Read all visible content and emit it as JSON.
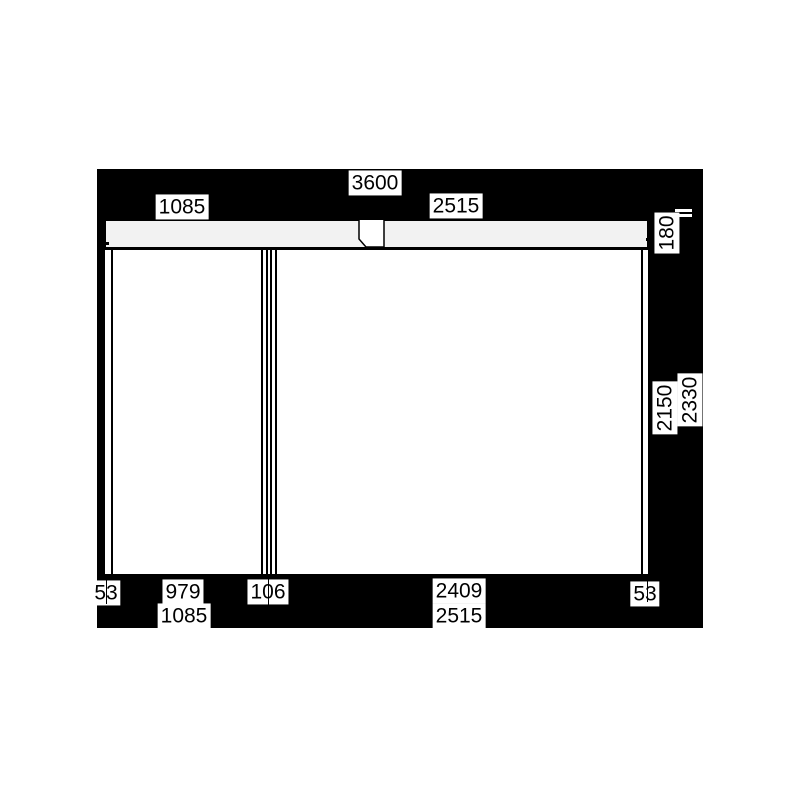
{
  "drawing": {
    "type": "roller-shutter-elevation",
    "colors": {
      "background": "#000000",
      "page": "#ffffff",
      "header_fill": "#f2f2f2",
      "line": "#000000",
      "label_bg": "#ffffff",
      "label_text": "#000000"
    },
    "dims": {
      "total_width": "3600",
      "top_left_section": "1085",
      "top_right_section": "2515",
      "header_height": "180",
      "panel_height": "2150",
      "total_height": "2330",
      "bottom_left_rail": "53",
      "bottom_left_panel": "979",
      "bottom_mullion": "106",
      "bottom_right_panel": "2409",
      "bottom_right_rail": "53",
      "bottom_left_section": "1085",
      "bottom_right_section": "2515"
    }
  }
}
